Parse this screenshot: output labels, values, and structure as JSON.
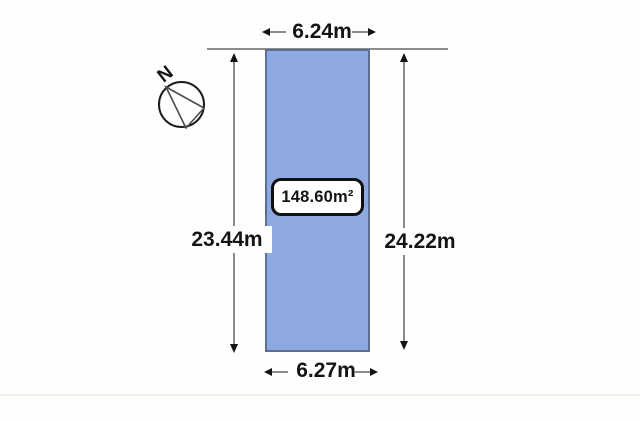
{
  "diagram": {
    "compass": {
      "label": "N"
    },
    "parcel": {
      "area_label": "148.60m²"
    },
    "dimensions": {
      "top": {
        "label": "6.24m"
      },
      "bottom": {
        "label": "6.27m"
      },
      "left": {
        "label": "23.44m"
      },
      "right": {
        "label": "24.22m"
      }
    },
    "colors": {
      "parcel-fill": "#8da9df",
      "parcel-border": "#5c6e91",
      "dimension-line": "#8c8c8c",
      "arrow-ink": "#141414",
      "text-ink": "#141414",
      "background": "#fefefd"
    }
  }
}
